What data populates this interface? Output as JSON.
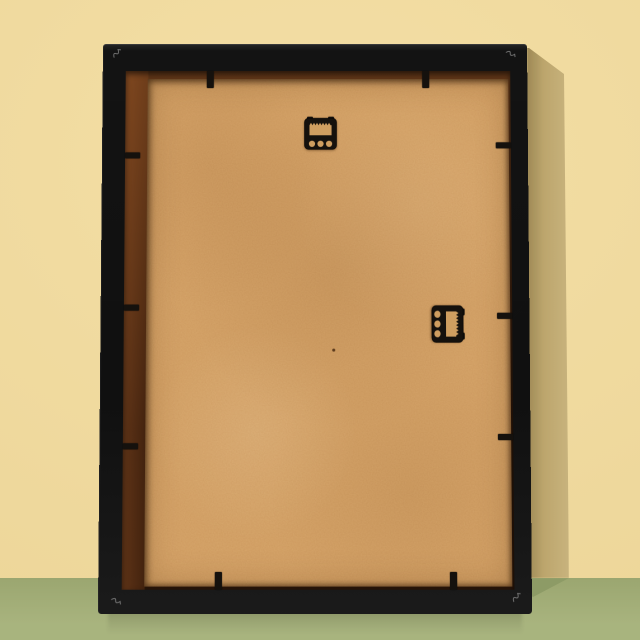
{
  "scene": {
    "title": "Back view of a black picture frame with tan MDF backing board, leaning against a pale yellow wall on a green surface",
    "wall": {
      "color": "#f3dc9e"
    },
    "floor": {
      "color": "#a3af76"
    },
    "shadow": {
      "wall_color": "#c3ac72",
      "floor_color": "#8d9b66"
    },
    "frame": {
      "color": "#131313",
      "rabbet_color": "#552d13",
      "board_color": "#d7a66b",
      "hardware_color": "#15110d",
      "hangers": [
        {
          "type": "sawtooth-hanger",
          "position": "top-center",
          "orientation": "horizontal",
          "holes": 3
        },
        {
          "type": "sawtooth-hanger",
          "position": "middle-right",
          "orientation": "vertical",
          "holes": 3
        }
      ],
      "flexi_tabs": {
        "top": 2,
        "bottom": 2,
        "left": 3,
        "right": 3
      },
      "v_nail_marks": 4
    }
  }
}
